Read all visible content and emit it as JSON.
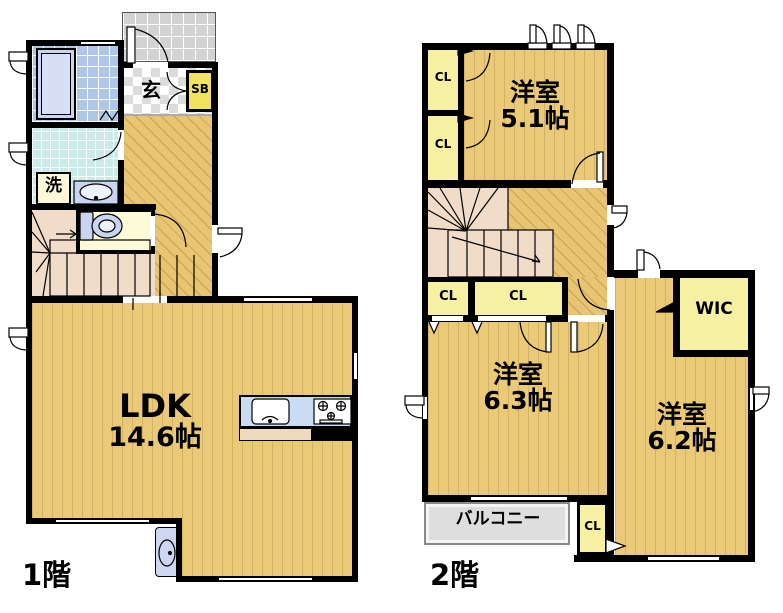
{
  "shared": {
    "closet_label": "CL"
  },
  "floor1": {
    "label": "1階",
    "rooms": {
      "ldk": {
        "name": "LDK",
        "size": "14.6帖"
      },
      "genkan": {
        "label": "玄"
      },
      "shoebox": {
        "label": "SB"
      },
      "laundry": {
        "label": "洗"
      }
    }
  },
  "floor2": {
    "label": "2階",
    "rooms": {
      "bedroom_5_1": {
        "name": "洋室",
        "size": "5.1帖"
      },
      "bedroom_6_3": {
        "name": "洋室",
        "size": "6.3帖"
      },
      "bedroom_6_2": {
        "name": "洋室",
        "size": "6.2帖"
      },
      "wic": {
        "label": "WIC"
      },
      "balcony": {
        "label": "バルコニー"
      }
    }
  },
  "colors": {
    "wall": "#000000",
    "wood_floor": "#EAC977",
    "stair_floor": "#F0DCC8",
    "closet_yellow": "#F6F0A2",
    "shoebox_yellow": "#F2E264",
    "toilet_yellow": "#FCFBD8",
    "bath_tile": "#AFC6E9",
    "laundry_tile": "#CBEBE8",
    "porch_gray": "#D3D3D3",
    "balcony_gray": "#DEDEDE",
    "kitchen_blue": "#CADCF4",
    "fixture_lavender": "#C9D4F0"
  }
}
